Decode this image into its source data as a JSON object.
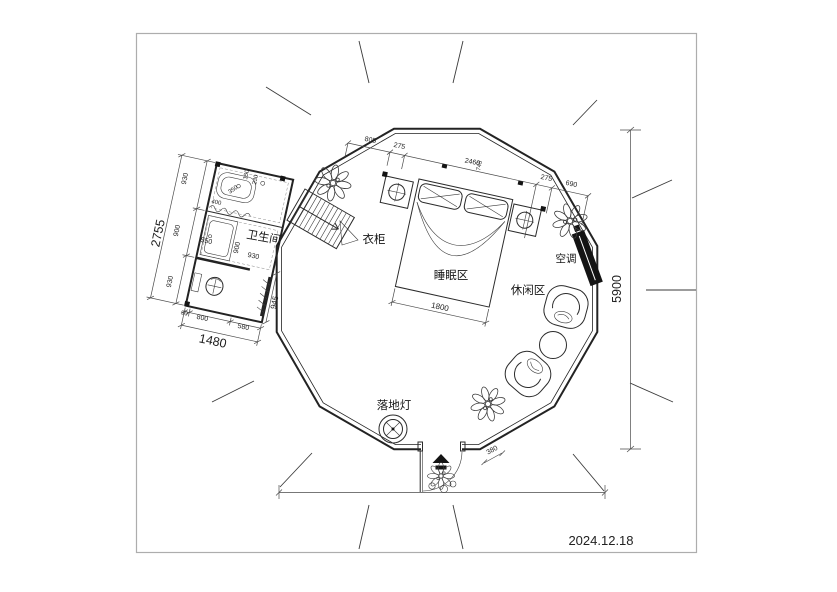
{
  "meta": {
    "date": "2024.12.18"
  },
  "labels": {
    "bathroom": "卫生间",
    "wardrobe": "衣柜",
    "sleeping_area": "睡眠区",
    "leisure_area": "休闲区",
    "air_conditioner": "空调",
    "floor_lamp": "落地灯"
  },
  "dimensions": {
    "top_chain": [
      "805",
      "275",
      "2460",
      "745",
      "275",
      "690"
    ],
    "right_height": "5900",
    "bed_width": "1800",
    "entrance_width": "380",
    "bathroom": {
      "left_chain": [
        "930",
        "900",
        "930"
      ],
      "left_total": "2755",
      "bottom_chain": [
        "90",
        "800",
        "580"
      ],
      "bottom_total": "1480",
      "side": "945",
      "interior": [
        "400",
        "350",
        "150",
        "230",
        "550",
        "900",
        "930"
      ]
    }
  },
  "colors": {
    "line": "#2b2b2b",
    "fill_black": "#141414",
    "frame": "#adadad",
    "paper": "#ffffff"
  }
}
